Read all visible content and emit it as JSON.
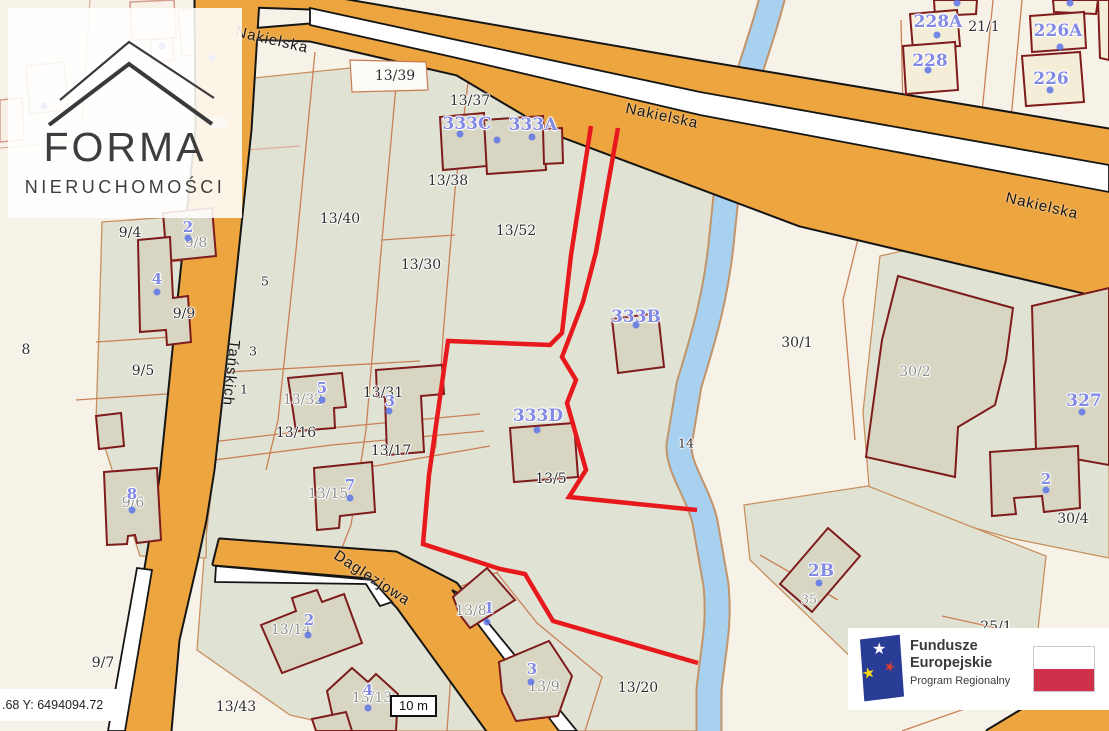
{
  "map": {
    "scalebar_label": "10 m",
    "coords_readout": ".68  Y: 6494094.72",
    "streets": [
      {
        "t": "Nakielska",
        "x": 272,
        "y": 40,
        "rot": 13
      },
      {
        "t": "Nakielska",
        "x": 662,
        "y": 116,
        "rot": 12
      },
      {
        "t": "Nakielska",
        "x": 1042,
        "y": 206,
        "rot": 13
      },
      {
        "t": "Tańskich",
        "x": 231,
        "y": 373,
        "rot": 96
      },
      {
        "t": "Daglezjowa",
        "x": 372,
        "y": 578,
        "rot": 33
      }
    ],
    "parcel_labels": [
      {
        "t": "13/39",
        "x": 395,
        "y": 76,
        "k": "dark"
      },
      {
        "t": "13/37",
        "x": 470,
        "y": 101,
        "k": "dark"
      },
      {
        "t": "13/38",
        "x": 448,
        "y": 181,
        "k": "dark"
      },
      {
        "t": "13/40",
        "x": 340,
        "y": 219,
        "k": "dark"
      },
      {
        "t": "13/52",
        "x": 516,
        "y": 231,
        "k": "dark"
      },
      {
        "t": "13/30",
        "x": 421,
        "y": 265,
        "k": "dark"
      },
      {
        "t": "30/1",
        "x": 797,
        "y": 343,
        "k": "dark"
      },
      {
        "t": "30/2",
        "x": 915,
        "y": 372,
        "k": "gray"
      },
      {
        "t": "30/4",
        "x": 1073,
        "y": 519,
        "k": "dark"
      },
      {
        "t": "13/32",
        "x": 303,
        "y": 400,
        "k": "gray"
      },
      {
        "t": "13/31",
        "x": 383,
        "y": 393,
        "k": "dark"
      },
      {
        "t": "13/16",
        "x": 296,
        "y": 433,
        "k": "dark"
      },
      {
        "t": "13/17",
        "x": 391,
        "y": 451,
        "k": "dark"
      },
      {
        "t": "13/15",
        "x": 328,
        "y": 494,
        "k": "gray"
      },
      {
        "t": "13/5",
        "x": 551,
        "y": 479,
        "k": "dark"
      },
      {
        "t": "14",
        "x": 686,
        "y": 443,
        "k": "dark",
        "sm": true
      },
      {
        "t": "9/4",
        "x": 130,
        "y": 233,
        "k": "dark"
      },
      {
        "t": "9/8",
        "x": 196,
        "y": 243,
        "k": "gray"
      },
      {
        "t": "9/9",
        "x": 184,
        "y": 314,
        "k": "dark"
      },
      {
        "t": "9/5",
        "x": 143,
        "y": 371,
        "k": "dark"
      },
      {
        "t": "9/6",
        "x": 133,
        "y": 503,
        "k": "gray"
      },
      {
        "t": "8",
        "x": 26,
        "y": 350,
        "k": "dark"
      },
      {
        "t": "5",
        "x": 265,
        "y": 281,
        "k": "dark",
        "sm": true
      },
      {
        "t": "3",
        "x": 253,
        "y": 351,
        "k": "dark",
        "sm": true
      },
      {
        "t": "1",
        "x": 244,
        "y": 389,
        "k": "dark",
        "sm": true
      },
      {
        "t": "24",
        "x": 219,
        "y": 122,
        "k": "gray",
        "sm": true
      },
      {
        "t": "21/1",
        "x": 984,
        "y": 27,
        "k": "dark"
      },
      {
        "t": "25/1",
        "x": 996,
        "y": 627,
        "k": "dark"
      },
      {
        "t": "35",
        "x": 809,
        "y": 599,
        "k": "gray",
        "sm": true
      },
      {
        "t": "9/7",
        "x": 103,
        "y": 663,
        "k": "dark"
      },
      {
        "t": "13/43",
        "x": 236,
        "y": 707,
        "k": "dark"
      },
      {
        "t": "13/14",
        "x": 291,
        "y": 630,
        "k": "gray"
      },
      {
        "t": "13/8",
        "x": 471,
        "y": 611,
        "k": "gray"
      },
      {
        "t": "13/9",
        "x": 544,
        "y": 687,
        "k": "gray"
      },
      {
        "t": "13/13",
        "x": 372,
        "y": 698,
        "k": "gray"
      },
      {
        "t": "13/20",
        "x": 638,
        "y": 688,
        "k": "dark"
      }
    ],
    "building_labels": [
      {
        "t": "333C",
        "x": 467,
        "y": 124,
        "big": true
      },
      {
        "t": "333A",
        "x": 533,
        "y": 125,
        "big": true
      },
      {
        "t": "333B",
        "x": 636,
        "y": 317,
        "big": true
      },
      {
        "t": "333D",
        "x": 538,
        "y": 416,
        "big": true
      },
      {
        "t": "228A",
        "x": 938,
        "y": 22,
        "big": true
      },
      {
        "t": "228",
        "x": 930,
        "y": 61,
        "big": true
      },
      {
        "t": "226A",
        "x": 1058,
        "y": 31,
        "big": true
      },
      {
        "t": "226",
        "x": 1051,
        "y": 79,
        "big": true
      },
      {
        "t": "327",
        "x": 1084,
        "y": 401,
        "big": true
      },
      {
        "t": "2",
        "x": 1046,
        "y": 479
      },
      {
        "t": "2B",
        "x": 821,
        "y": 571,
        "big": true
      },
      {
        "t": "5",
        "x": 322,
        "y": 388
      },
      {
        "t": "3",
        "x": 390,
        "y": 401
      },
      {
        "t": "7",
        "x": 350,
        "y": 485
      },
      {
        "t": "2",
        "x": 188,
        "y": 227
      },
      {
        "t": "4",
        "x": 157,
        "y": 279
      },
      {
        "t": "8",
        "x": 132,
        "y": 494
      },
      {
        "t": "2",
        "x": 309,
        "y": 620
      },
      {
        "t": "4",
        "x": 368,
        "y": 690
      },
      {
        "t": "1",
        "x": 489,
        "y": 608
      },
      {
        "t": "3",
        "x": 532,
        "y": 669
      }
    ],
    "address_dots": [
      [
        460,
        134
      ],
      [
        497,
        140
      ],
      [
        532,
        137
      ],
      [
        636,
        325
      ],
      [
        537,
        430
      ],
      [
        937,
        35
      ],
      [
        928,
        70
      ],
      [
        957,
        3
      ],
      [
        1060,
        47
      ],
      [
        1050,
        90
      ],
      [
        1070,
        3
      ],
      [
        1082,
        412
      ],
      [
        1046,
        490
      ],
      [
        819,
        583
      ],
      [
        322,
        400
      ],
      [
        389,
        411
      ],
      [
        350,
        498
      ],
      [
        188,
        238
      ],
      [
        157,
        292
      ],
      [
        132,
        510
      ],
      [
        308,
        635
      ],
      [
        368,
        708
      ],
      [
        487,
        622
      ],
      [
        531,
        682
      ],
      [
        44,
        106
      ],
      [
        162,
        46
      ],
      [
        212,
        58
      ]
    ],
    "colors": {
      "background_cream": "#f7f2e8",
      "parcel_green": "#e0e3d4",
      "road_orange": "#eda540",
      "road_edge": "#151515",
      "river_fill": "#a8d1ef",
      "river_edge": "#c1946a",
      "parcel_line": "#c8794f",
      "building_stroke": "#7e1c1c",
      "building_fill": "#d8d6c3",
      "building_fill_cream": "#f4eed8",
      "selection_red": "#e8191d",
      "label_blue": "#8289e4"
    }
  },
  "forma_logo": {
    "title": "FORMA",
    "subtitle": "NIERUCHOMOŚCI"
  },
  "eu_banner": {
    "line1": "Fundusze",
    "line2": "Europejskie",
    "line3": "Program Regionalny"
  }
}
